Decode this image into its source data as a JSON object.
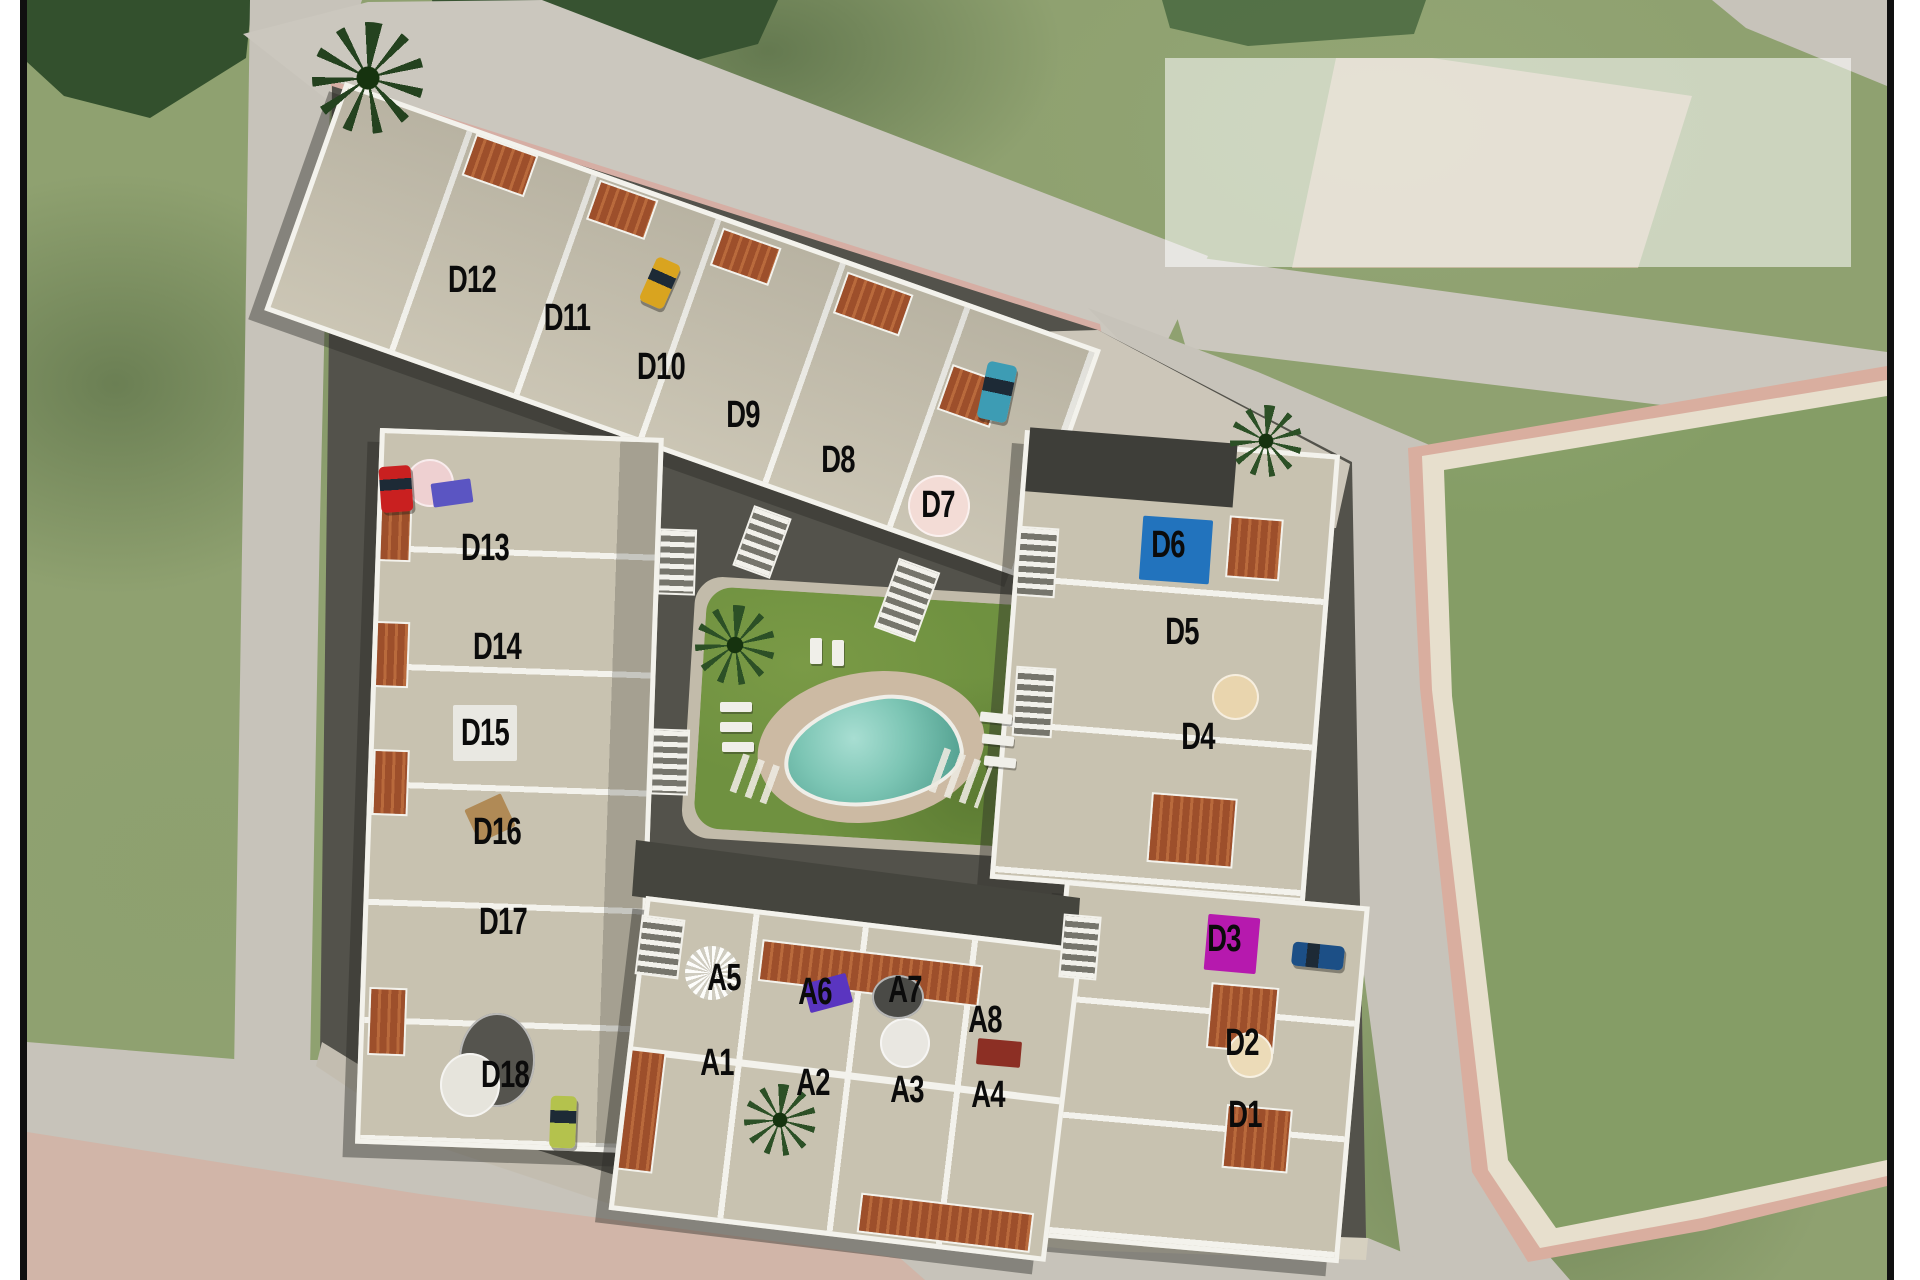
{
  "scene": {
    "description": "Aerial site plan of residential development with labeled units",
    "label_color": "#0b0b0b",
    "frame_border_color": "#101010",
    "margin_color": "#ffffff"
  },
  "site": {
    "unit_labels": [
      {
        "id": "D12",
        "x": 472,
        "y": 280
      },
      {
        "id": "D11",
        "x": 567,
        "y": 318
      },
      {
        "id": "D10",
        "x": 661,
        "y": 367
      },
      {
        "id": "D9",
        "x": 743,
        "y": 415
      },
      {
        "id": "D8",
        "x": 838,
        "y": 460
      },
      {
        "id": "D7",
        "x": 938,
        "y": 505
      },
      {
        "id": "D6",
        "x": 1168,
        "y": 545
      },
      {
        "id": "D5",
        "x": 1182,
        "y": 632
      },
      {
        "id": "D4",
        "x": 1198,
        "y": 737
      },
      {
        "id": "D3",
        "x": 1224,
        "y": 939
      },
      {
        "id": "D2",
        "x": 1242,
        "y": 1043
      },
      {
        "id": "D1",
        "x": 1245,
        "y": 1115
      },
      {
        "id": "D13",
        "x": 485,
        "y": 548
      },
      {
        "id": "D14",
        "x": 497,
        "y": 647
      },
      {
        "id": "D15",
        "x": 485,
        "y": 733
      },
      {
        "id": "D16",
        "x": 497,
        "y": 832
      },
      {
        "id": "D17",
        "x": 503,
        "y": 922
      },
      {
        "id": "D18",
        "x": 505,
        "y": 1075
      },
      {
        "id": "A5",
        "x": 724,
        "y": 978
      },
      {
        "id": "A6",
        "x": 815,
        "y": 992
      },
      {
        "id": "A7",
        "x": 905,
        "y": 990
      },
      {
        "id": "A8",
        "x": 985,
        "y": 1020
      },
      {
        "id": "A1",
        "x": 717,
        "y": 1063
      },
      {
        "id": "A2",
        "x": 813,
        "y": 1083
      },
      {
        "id": "A3",
        "x": 907,
        "y": 1090
      },
      {
        "id": "A4",
        "x": 988,
        "y": 1095
      }
    ],
    "markers": {
      "d6_rooftop_pool_color": "#2273bd",
      "d3_roof_marker_color": "#b619ae"
    },
    "decor": [
      {
        "n": "d6-rooftop-pool",
        "s": "rect",
        "c": "#2273bd",
        "x": 1141,
        "y": 518,
        "w": 70,
        "h": 64,
        "rot": 4
      },
      {
        "n": "d3-roof-marker",
        "s": "rect",
        "c": "#b619ae",
        "x": 1206,
        "y": 916,
        "w": 52,
        "h": 56,
        "rot": 5
      },
      {
        "n": "d7-pink-umbrella",
        "s": "ellipse",
        "c": "#f3dcd6",
        "x": 908,
        "y": 475,
        "w": 62,
        "h": 62,
        "rot": 0
      },
      {
        "n": "d13-pink-umbrella",
        "s": "ellipse",
        "c": "#eed0d1",
        "x": 406,
        "y": 459,
        "w": 48,
        "h": 48,
        "rot": 0
      },
      {
        "n": "d13-blue-lounger",
        "s": "rect",
        "c": "#5b55c2",
        "x": 432,
        "y": 481,
        "w": 40,
        "h": 24,
        "rot": -8
      },
      {
        "n": "d4-cream-umbrella",
        "s": "ellipse",
        "c": "#e9d5ae",
        "x": 1212,
        "y": 674,
        "w": 47,
        "h": 46,
        "rot": 0
      },
      {
        "n": "d2-cream-umbrella",
        "s": "ellipse",
        "c": "#ecdbb8",
        "x": 1227,
        "y": 1032,
        "w": 46,
        "h": 46,
        "rot": 0
      },
      {
        "n": "a3-white-umbrella",
        "s": "ellipse",
        "c": "#e9e7e1",
        "x": 880,
        "y": 1018,
        "w": 50,
        "h": 50,
        "rot": 0
      },
      {
        "n": "a3-dark-table",
        "s": "ellipse",
        "c": "#4a4a46",
        "x": 872,
        "y": 975,
        "w": 52,
        "h": 44,
        "rot": 0
      },
      {
        "n": "a5-white-parasol",
        "s": "fan",
        "c": "#f1f0ea",
        "x": 685,
        "y": 946,
        "w": 54,
        "h": 54,
        "rot": 0
      },
      {
        "n": "a6-purple-loungers",
        "s": "rect",
        "c": "#5a35c0",
        "x": 806,
        "y": 978,
        "w": 44,
        "h": 30,
        "rot": -15
      },
      {
        "n": "a4-bbq-set",
        "s": "rect",
        "c": "#8c2f24",
        "x": 977,
        "y": 1040,
        "w": 44,
        "h": 26,
        "rot": 5
      },
      {
        "n": "d15-white-terrace",
        "s": "rect",
        "c": "#e9e8e2",
        "x": 453,
        "y": 705,
        "w": 64,
        "h": 56,
        "rot": 0
      },
      {
        "n": "d16-wood-loungers",
        "s": "rect",
        "c": "#b08a56",
        "x": 470,
        "y": 800,
        "w": 40,
        "h": 36,
        "rot": -25
      },
      {
        "n": "d18-dark-terrace",
        "s": "ellipse",
        "c": "#55544e",
        "x": 459,
        "y": 1013,
        "w": 76,
        "h": 94,
        "rot": 0
      },
      {
        "n": "d18-white-terrace",
        "s": "ellipse",
        "c": "#e6e4dc",
        "x": 440,
        "y": 1053,
        "w": 60,
        "h": 64,
        "rot": 0
      },
      {
        "n": "palm-entrance",
        "s": "palm",
        "c": "#24421f",
        "x": 312,
        "y": 22,
        "w": 112,
        "h": 112,
        "rot": 0
      },
      {
        "n": "palm-junction",
        "s": "palm",
        "c": "#2c5026",
        "x": 1230,
        "y": 405,
        "w": 72,
        "h": 72,
        "rot": 0
      },
      {
        "n": "palm-courtyard",
        "s": "palm",
        "c": "#2c5026",
        "x": 695,
        "y": 605,
        "w": 80,
        "h": 80,
        "rot": 0
      },
      {
        "n": "palm-a2",
        "s": "palm",
        "c": "#2c5026",
        "x": 744,
        "y": 1084,
        "w": 72,
        "h": 72,
        "rot": 0
      },
      {
        "n": "stairs-1",
        "s": "stairs",
        "c": "",
        "x": 658,
        "y": 529,
        "w": 34,
        "h": 62,
        "rot": 2
      },
      {
        "n": "stairs-2",
        "s": "stairs",
        "c": "",
        "x": 651,
        "y": 729,
        "w": 34,
        "h": 62,
        "rot": 2
      },
      {
        "n": "stairs-3",
        "s": "stairs",
        "c": "",
        "x": 1017,
        "y": 527,
        "w": 36,
        "h": 66,
        "rot": 4
      },
      {
        "n": "stairs-4",
        "s": "stairs",
        "c": "",
        "x": 1014,
        "y": 667,
        "w": 36,
        "h": 66,
        "rot": 4
      },
      {
        "n": "stairs-5",
        "s": "stairs",
        "c": "",
        "x": 1061,
        "y": 915,
        "w": 34,
        "h": 60,
        "rot": 5
      },
      {
        "n": "stairs-6",
        "s": "stairs",
        "c": "",
        "x": 638,
        "y": 917,
        "w": 40,
        "h": 56,
        "rot": 7
      },
      {
        "n": "stairs-7",
        "s": "stairs",
        "c": "",
        "x": 885,
        "y": 563,
        "w": 40,
        "h": 70,
        "rot": 20
      },
      {
        "n": "stairs-8",
        "s": "stairs",
        "c": "",
        "x": 742,
        "y": 510,
        "w": 36,
        "h": 60,
        "rot": 20
      },
      {
        "n": "crossing-dashes-left",
        "s": "dashes",
        "c": "",
        "x": 735,
        "y": 760,
        "w": 46,
        "h": 40,
        "rot": 20
      },
      {
        "n": "crossing-dashes-right",
        "s": "dashes",
        "c": "",
        "x": 935,
        "y": 755,
        "w": 52,
        "h": 46,
        "rot": 20
      },
      {
        "n": "lounger-1",
        "s": "lounger",
        "c": "",
        "x": 720,
        "y": 702,
        "w": 32,
        "h": 10,
        "rot": 0
      },
      {
        "n": "lounger-2",
        "s": "lounger",
        "c": "",
        "x": 720,
        "y": 722,
        "w": 32,
        "h": 10,
        "rot": 0
      },
      {
        "n": "lounger-3",
        "s": "lounger",
        "c": "",
        "x": 722,
        "y": 742,
        "w": 32,
        "h": 10,
        "rot": 0
      },
      {
        "n": "lounger-4",
        "s": "lounger",
        "c": "",
        "x": 980,
        "y": 713,
        "w": 32,
        "h": 10,
        "rot": 6
      },
      {
        "n": "lounger-5",
        "s": "lounger",
        "c": "",
        "x": 982,
        "y": 735,
        "w": 32,
        "h": 10,
        "rot": 6
      },
      {
        "n": "lounger-6",
        "s": "lounger",
        "c": "",
        "x": 984,
        "y": 757,
        "w": 32,
        "h": 10,
        "rot": 6
      },
      {
        "n": "lounger-7",
        "s": "lounger",
        "c": "",
        "x": 810,
        "y": 638,
        "w": 12,
        "h": 26,
        "rot": 0
      },
      {
        "n": "lounger-8",
        "s": "lounger",
        "c": "",
        "x": 832,
        "y": 640,
        "w": 12,
        "h": 26,
        "rot": 0
      }
    ],
    "cars": [
      {
        "n": "yellow-car",
        "c": "#d9a41f",
        "x": 647,
        "y": 259,
        "w": 26,
        "h": 48,
        "rot": 24
      },
      {
        "n": "teal-car",
        "c": "#3d9cb4",
        "x": 982,
        "y": 363,
        "w": 30,
        "h": 58,
        "rot": 12
      },
      {
        "n": "red-car",
        "c": "#c92020",
        "x": 380,
        "y": 466,
        "w": 32,
        "h": 46,
        "rot": -4
      },
      {
        "n": "blue-car",
        "c": "#1c4f86",
        "x": 1292,
        "y": 944,
        "w": 52,
        "h": 24,
        "rot": 6
      },
      {
        "n": "green-van",
        "c": "#b4c24d",
        "x": 550,
        "y": 1096,
        "w": 26,
        "h": 52,
        "rot": 2
      }
    ]
  }
}
